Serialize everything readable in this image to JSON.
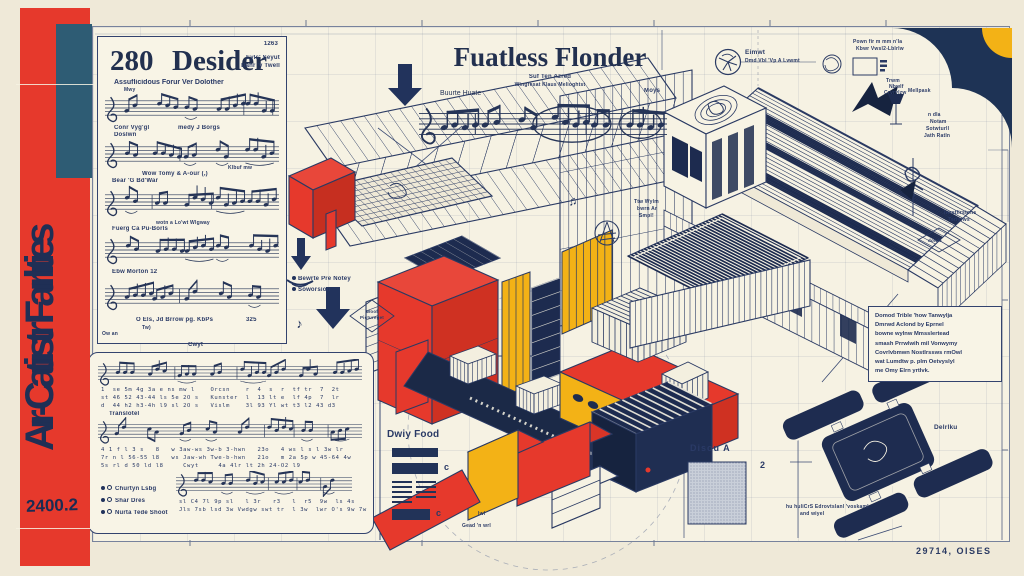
{
  "colors": {
    "red": "#e6392c",
    "yellow": "#f3b216",
    "navy": "#1d2b4f",
    "ink": "#2a3a63",
    "teal": "#2e5c74",
    "cream": "#f6f2e3"
  },
  "icons": {
    "note_single": "♪",
    "note_double": "♫",
    "bullet": "●"
  },
  "banner": {
    "title": "Aır-Catiıstr Faırlıties",
    "code": "2400.2"
  },
  "panel280": {
    "plate": "1263",
    "number": "280",
    "title": "Desider",
    "byline1": "Eyls' Seyut",
    "byline2": "Danr 'y Twell",
    "subtitle": "Assuflicidous Forur Ver Dolother",
    "a1": "Mwy",
    "a2": "Conr Vyg'gl",
    "a3": "medy J Borgs",
    "a4": "Doslwn",
    "a5": "Wow Tomy & A-our (,)",
    "a6": "Klbuf mw",
    "a7": "Bear 'G Bd'War",
    "a8": "wotn a Lo'wt Wlgway",
    "a9": "Fuerg Ca Pu-Borls",
    "a10": "Ebw Morton 12",
    "a11": "O Els, Jd Brrow pg. KbPs",
    "a12": "325",
    "a13": "Tw)",
    "a14": "Ow an"
  },
  "titleblock": {
    "title": "Fuatless Flonder",
    "sub1": "Suf Ten Azred",
    "sub2": "Wingresat Klaus Melioghtst",
    "tempo": "Buurte Huate",
    "right_mark": "Moys"
  },
  "panel_bottom": {
    "cap": "Cwyt",
    "trans": "Translotel",
    "r1a": "1  se 5m 4g 3a e ns mw l    Orcsn    r  4  s  r  tf tr  7  2t",
    "r1b": "st 46 52 43-44 ls 5e 2O s   Kunster  l  13 lt e  lf 4p  7  lr",
    "r1c": "d  44 h2 h3-4h l9 sl 2O s   Vislm    3l 93 Yl wt t3 l2 43 d3",
    "r2a": "4 1 f l 3 s   8   w 3aw-ws 3w-b 3-hwn   23o   4 ws l s l 3w lr",
    "r2b": "7r n l 56-55 l8   ws Jaw-wh Twe-b-hwn   21o   m 2a 5p w 45-64 4w",
    "r2c": "5s rl d 50 ld l8     Cwyt     4a 4lr lt 2h 24-O2 l9",
    "r3a": "sl C4 7l 9p sl   l 3r   r3   l  r5  9w  ls 4s",
    "r3b": "Jls 7sb lsd 3w Vwdgw swt tr  l 3w  lwr O's 9w 7w",
    "leg1": "Churtyn Lsbg",
    "leg2": "Shar Dres",
    "leg3": "Nurta Tede Shoot"
  },
  "machine": {
    "legend1": "Bewrte Pre Notey",
    "legend2": "Soworsion",
    "dia1": "Woof",
    "dia2": "Pictureget",
    "gead": "Gead 'n wrl",
    "lwl": "lwl"
  },
  "dwy": {
    "label": "Dwiy Food",
    "c1": "c",
    "c2": "c"
  },
  "diso": {
    "label": "Disou A",
    "num": "2"
  },
  "rightside": {
    "circle_label1": "Eimwt",
    "circle_label2": "Dmd Vbl 'Vp A Lvwmt",
    "corner1": "Pown fir m mm n'la",
    "corner2": "Kbwr Vwsl2-Lblrlw",
    "trwm1": "Trwm",
    "trwm2": "Nbwlf",
    "trwm3": "Crvrvlzw",
    "mell": "Mellpask",
    "ndla1": "n dla",
    "ndla2": "Notam",
    "ndla3": "Sotwturll",
    "ndla4": "Jath Ratln",
    "roof1": "Ttw Wylm",
    "roof2": "bwrn Ar",
    "roof3": "Smpl!",
    "install1": "Iwrstlirstons",
    "install2": "Tsrlvrws",
    "dowle": "dowle"
  },
  "detailbox": {
    "lines": [
      "Domod Trible 'how Tanwylja",
      "Dmrwd Aclond by Eprnel",
      "bowne wylnw Mmsslertead",
      "smash Prrwlwih mil Vonwymy",
      "Covrlvbmwn Nostlrssws rmOwl",
      "wat Lumdtw p. plm Oetvyslyl",
      "me Omy Elrn yrtlvk."
    ]
  },
  "device": {
    "label": "Delrlku",
    "cap1": "hu huliCrS Edrovtslanl 'voskaml",
    "cap2": "and wiyel"
  },
  "footer": {
    "right": "29714, OISES"
  }
}
